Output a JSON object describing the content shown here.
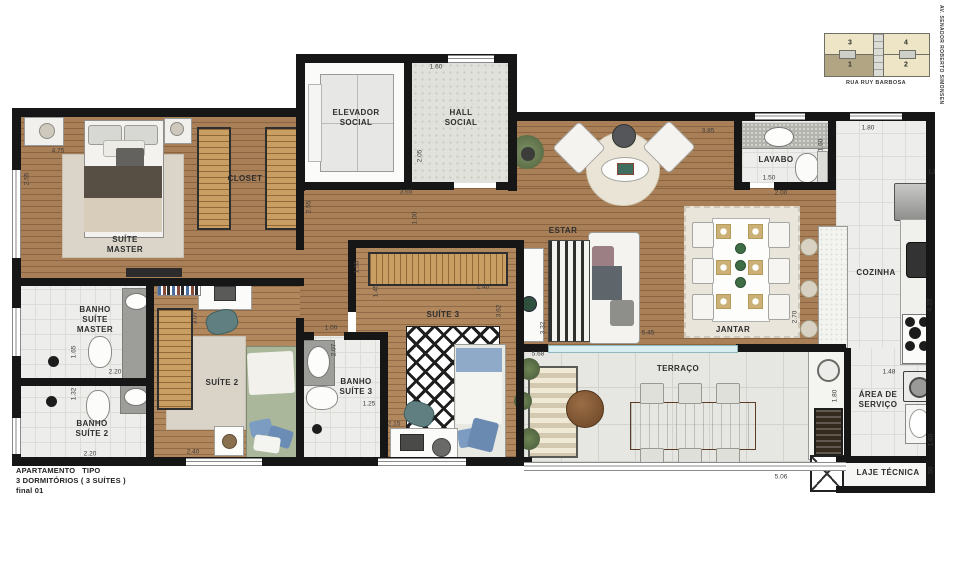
{
  "title_block": {
    "line1": "APARTAMENTO   TIPO",
    "line2": "3 DORMITÓRIOS ( 3 SUÍTES )",
    "line3": "final 01"
  },
  "key_plan": {
    "units": [
      {
        "n": "3"
      },
      {
        "n": "4"
      },
      {
        "n": "1"
      },
      {
        "n": "2"
      }
    ],
    "highlighted_unit": "1",
    "street_bottom": "RUA RUY BARBOSA",
    "street_side": "AV. SENADOR ROBERTO SIMONSEN"
  },
  "rooms": [
    {
      "label": "SUÍTE\nMASTER",
      "x": 125,
      "y": 245
    },
    {
      "label": "CLOSET",
      "x": 245,
      "y": 179
    },
    {
      "label": "ELEVADOR\nSOCIAL",
      "x": 356,
      "y": 118
    },
    {
      "label": "HALL\nSOCIAL",
      "x": 461,
      "y": 118
    },
    {
      "label": "LAVABO",
      "x": 776,
      "y": 160
    },
    {
      "label": "ESTAR",
      "x": 563,
      "y": 231
    },
    {
      "label": "JANTAR",
      "x": 733,
      "y": 330
    },
    {
      "label": "COZINHA",
      "x": 876,
      "y": 273
    },
    {
      "label": "BANHO\nSUÍTE\nMASTER",
      "x": 95,
      "y": 320
    },
    {
      "label": "BANHO\nSUÍTE 2",
      "x": 92,
      "y": 429
    },
    {
      "label": "SUÍTE 2",
      "x": 222,
      "y": 383
    },
    {
      "label": "SUÍTE 3",
      "x": 443,
      "y": 315
    },
    {
      "label": "BANHO\nSUÍTE 3",
      "x": 356,
      "y": 387
    },
    {
      "label": "TERRAÇO",
      "x": 678,
      "y": 369
    },
    {
      "label": "ÁREA DE\nSERVIÇO",
      "x": 878,
      "y": 400
    },
    {
      "label": "LAJE TÉCNICA",
      "x": 888,
      "y": 473
    }
  ],
  "dimensions": [
    {
      "t": "4.75",
      "x": 58,
      "y": 151,
      "v": false
    },
    {
      "t": "2.55",
      "x": 27,
      "y": 179,
      "v": true
    },
    {
      "t": "1.60",
      "x": 436,
      "y": 67,
      "v": false
    },
    {
      "t": "2.05",
      "x": 420,
      "y": 156,
      "v": true
    },
    {
      "t": "3.65",
      "x": 406,
      "y": 192,
      "v": false
    },
    {
      "t": "2.55",
      "x": 309,
      "y": 207,
      "v": true
    },
    {
      "t": "1.00",
      "x": 415,
      "y": 218,
      "v": true
    },
    {
      "t": "3.85",
      "x": 708,
      "y": 131,
      "v": false
    },
    {
      "t": "1.80",
      "x": 868,
      "y": 128,
      "v": false
    },
    {
      "t": "1.50",
      "x": 769,
      "y": 178,
      "v": false
    },
    {
      "t": "1.60",
      "x": 821,
      "y": 145,
      "v": true
    },
    {
      "t": "LJ",
      "x": 932,
      "y": 172,
      "v": false
    },
    {
      "t": "2.00",
      "x": 781,
      "y": 193,
      "v": false
    },
    {
      "t": "2.70",
      "x": 795,
      "y": 317,
      "v": true
    },
    {
      "t": "5.45",
      "x": 648,
      "y": 333,
      "v": false
    },
    {
      "t": "4.15",
      "x": 930,
      "y": 305,
      "v": true
    },
    {
      "t": "1.48",
      "x": 889,
      "y": 372,
      "v": false
    },
    {
      "t": "1.60",
      "x": 931,
      "y": 440,
      "v": true
    },
    {
      "t": ".50",
      "x": 931,
      "y": 471,
      "v": true
    },
    {
      "t": "5.68",
      "x": 538,
      "y": 354,
      "v": false
    },
    {
      "t": "5.06",
      "x": 781,
      "y": 477,
      "v": false
    },
    {
      "t": "1.80",
      "x": 835,
      "y": 396,
      "v": true
    },
    {
      "t": "2.20",
      "x": 115,
      "y": 372,
      "v": false
    },
    {
      "t": "1.65",
      "x": 74,
      "y": 352,
      "v": true
    },
    {
      "t": "1.32",
      "x": 74,
      "y": 394,
      "v": true
    },
    {
      "t": "2.20",
      "x": 90,
      "y": 454,
      "v": false
    },
    {
      "t": "2.40",
      "x": 193,
      "y": 452,
      "v": false
    },
    {
      "t": "3.07",
      "x": 195,
      "y": 318,
      "v": true
    },
    {
      "t": "1.00",
      "x": 331,
      "y": 328,
      "v": false
    },
    {
      "t": "1.55",
      "x": 357,
      "y": 267,
      "v": true
    },
    {
      "t": "1.45",
      "x": 376,
      "y": 291,
      "v": true
    },
    {
      "t": "2.40",
      "x": 483,
      "y": 287,
      "v": false
    },
    {
      "t": "3.62",
      "x": 499,
      "y": 311,
      "v": true
    },
    {
      "t": "2.15",
      "x": 394,
      "y": 424,
      "v": false
    },
    {
      "t": "2.07",
      "x": 334,
      "y": 350,
      "v": true
    },
    {
      "t": "1.25",
      "x": 369,
      "y": 404,
      "v": false
    },
    {
      "t": "3.32",
      "x": 543,
      "y": 328,
      "v": true
    }
  ],
  "colors": {
    "wall": "#161616",
    "wood": "#a97f57",
    "tile": "#ededeb",
    "terrace": "#e6e6e3",
    "furniture_wood": "#8a5e3a",
    "keyplan_unit": "#ede5c6",
    "keyplan_highlight": "#b2a584"
  }
}
